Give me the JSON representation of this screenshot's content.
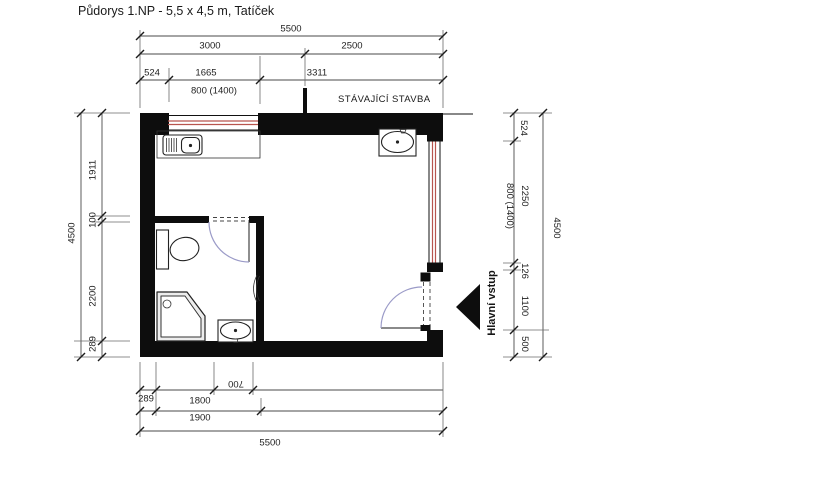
{
  "title": "Půdorys 1.NP -  5,5 x 4,5 m, Tatíček",
  "labels": {
    "existing_building": "STÁVAJÍCÍ STAVBA",
    "main_entrance": "Hlavní vstup"
  },
  "dimensions": {
    "top": {
      "total": "5500",
      "left_span": "3000",
      "right_span": "2500",
      "wall": "524",
      "window": "1665",
      "rest": "3311",
      "window_note": "800 (1400)"
    },
    "left": {
      "total": "4500",
      "seg1": "1911",
      "seg2": "100",
      "seg3": "2200",
      "seg4": "289"
    },
    "right": {
      "total": "4500",
      "seg1": "524",
      "seg2": "2250",
      "seg3": "126",
      "seg4": "1100",
      "seg5": "500",
      "window_note": "800 (1400)"
    },
    "bottom": {
      "wall": "289",
      "bath_width": "1800",
      "basin": "700",
      "bath_outer": "1900",
      "total": "5500"
    }
  },
  "fixtures": {
    "kitchen_sink": "kitchen-sink-icon",
    "washbasin_main": "washbasin-icon",
    "toilet": "toilet-icon",
    "shower": "corner-shower-icon",
    "washbasin_bath": "washbasin-icon",
    "radiator": "radiator-icon",
    "entrance_arrow": "entrance-arrow-icon"
  },
  "colors": {
    "wall": "#0d0d0d",
    "window_line": "#b8544e",
    "door_arc": "#9b9bc8",
    "dim_line": "#4a4a4a",
    "text": "#1f1f1f"
  }
}
